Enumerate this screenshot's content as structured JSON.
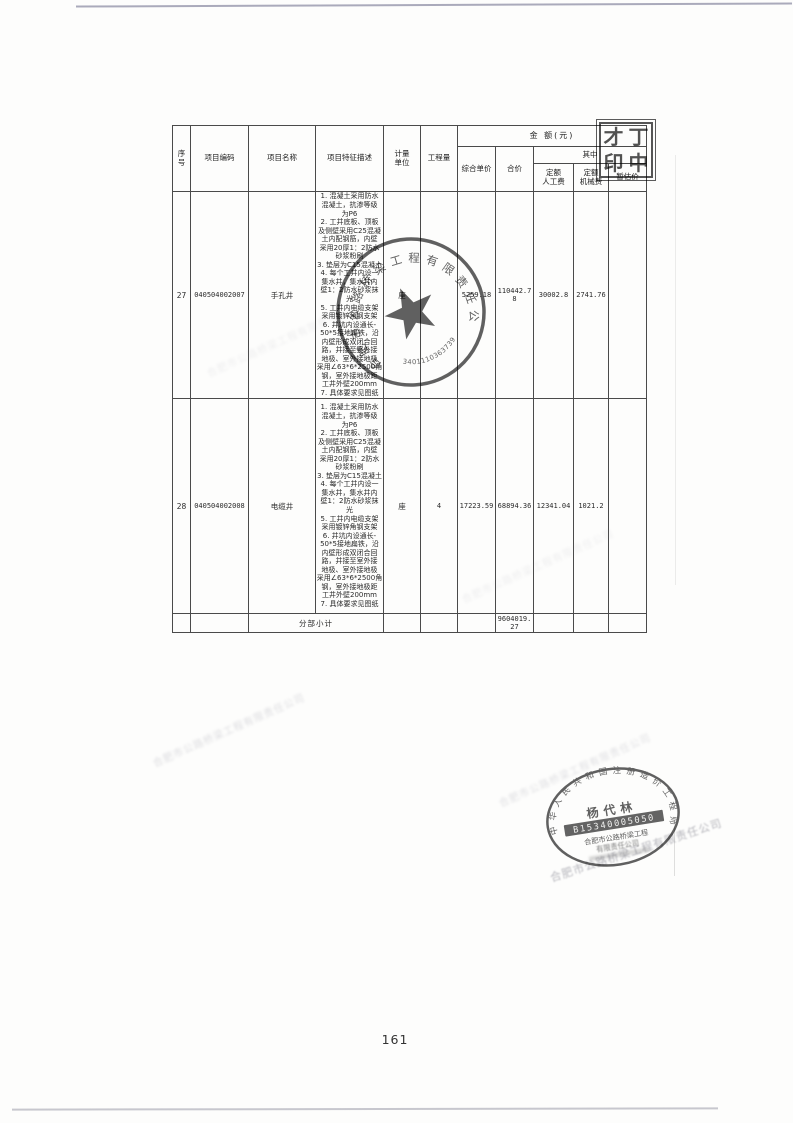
{
  "page": {
    "number": "161"
  },
  "table": {
    "header": {
      "seq": "序\n号",
      "code": "项目编码",
      "name": "项目名称",
      "desc": "项目特征描述",
      "unit": "计量\n单位",
      "qty": "工程量",
      "amount_group": "金  额(元)",
      "unit_price": "综合单价",
      "total": "合价",
      "among": "其中",
      "labor": "定额\n人工费",
      "machine": "定额\n机械费",
      "provisional": "暂估价"
    },
    "rows": [
      {
        "seq": "27",
        "code": "040504002007",
        "name": "手孔井",
        "desc": "1. 混凝土采用防水\n混凝土，抗渗等级\n为P6\n2. 工井底板、顶板\n及侧壁采用C25混凝\n土内配钢筋，内壁\n采用20厚1：2防水\n砂浆粉刷\n3. 垫层为C15混凝土\n4. 每个工井内设一\n集水井，集水井内\n壁1：2防水砂浆抹\n光\n5. 工井内电缆支架\n采用镀锌角钢支架\n6. 井坑内设通长-\n50*5接地扁铁，沿\n内壁形成双闭合回\n路，并接至室外接\n地极、室外接地极\n采用∠63*6*2500角\n钢，室外接地极距\n工井外壁200mm\n7. 具体要求见图纸",
        "unit": "座",
        "qty": "",
        "unit_price": "5259.18",
        "total": "110442.78",
        "labor": "30002.8",
        "machine": "2741.76",
        "provisional": ""
      },
      {
        "seq": "28",
        "code": "040504002008",
        "name": "电缆井",
        "desc": "1. 混凝土采用防水\n混凝土，抗渗等级\n为P6\n2. 工井底板、顶板\n及侧壁采用C25混凝\n土内配钢筋，内壁\n采用20厚1：2防水\n砂浆粉刷\n3. 垫层为C15混凝土\n4. 每个工井内设一\n集水井，集水井内\n壁1：2防水砂浆抹\n光\n5. 工井内电缆支架\n采用镀锌角钢支架\n6. 井坑内设通长-\n50*5接地扁铁，沿\n内壁形成双闭合回\n路，并接至室外接\n地极、室外接地极\n采用∠63*6*2500角\n钢，室外接地极距\n工井外壁200mm\n7. 具体要求见图纸",
        "unit": "座",
        "qty": "4",
        "unit_price": "17223.59",
        "total": "68894.36",
        "labor": "12341.04",
        "machine": "1021.2",
        "provisional": ""
      }
    ],
    "subtotal": {
      "label": "分部小计",
      "total": "9604019.27"
    }
  },
  "stamps": {
    "print_stamp": {
      "chars": [
        "才",
        "丁",
        "印",
        "中"
      ]
    },
    "company_seal": {
      "text": "合肥市公路桥梁工程有限责任公司",
      "number": "3401110363739"
    },
    "engineer_seal": {
      "arc": "中华人民共和国注册造价工程师",
      "person": "杨代林",
      "number": "B15340005050",
      "line1": "合肥市公路桥梁工程",
      "line2": "有限责任公司"
    }
  },
  "watermark": {
    "text": "合肥市公路桥梁工程有限责任公司"
  }
}
